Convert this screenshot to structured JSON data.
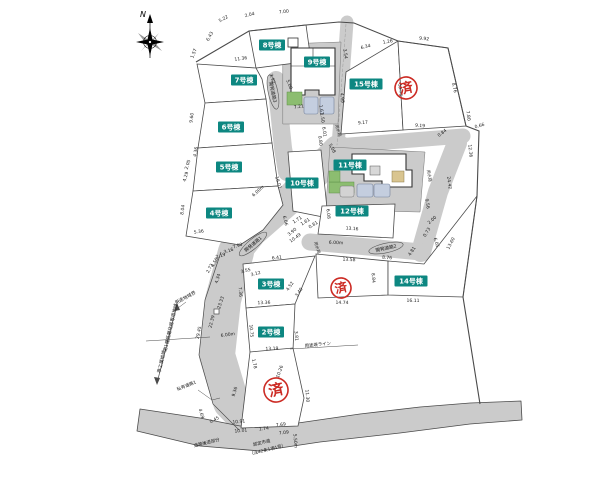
{
  "map": {
    "width": 600,
    "height": 477,
    "background": "#ffffff"
  },
  "colors": {
    "road": "#cbcbcb",
    "lot_fill": "#ffffff",
    "line": "#4a4a4a",
    "chip_bg": "#0d8781",
    "chip_text": "#ffffff",
    "stamp_red": "#cc2b24",
    "green": "#8cbd70",
    "parking_blue": "#c4cedf",
    "tan": "#d9c590"
  },
  "compass": {
    "label": "N",
    "x": 150,
    "y": 42
  },
  "lot_chips": [
    {
      "label": "8号棟",
      "x": 272,
      "y": 45
    },
    {
      "label": "9号棟",
      "x": 317,
      "y": 62
    },
    {
      "label": "7号棟",
      "x": 244,
      "y": 80
    },
    {
      "label": "15号棟",
      "x": 366,
      "y": 84
    },
    {
      "label": "6号棟",
      "x": 231,
      "y": 127
    },
    {
      "label": "5号棟",
      "x": 229,
      "y": 167
    },
    {
      "label": "11号棟",
      "x": 350,
      "y": 165
    },
    {
      "label": "10号棟",
      "x": 302,
      "y": 183
    },
    {
      "label": "12号棟",
      "x": 352,
      "y": 211
    },
    {
      "label": "4号棟",
      "x": 219,
      "y": 213
    },
    {
      "label": "3号棟",
      "x": 271,
      "y": 284
    },
    {
      "label": "14号棟",
      "x": 411,
      "y": 281
    },
    {
      "label": "2号棟",
      "x": 271,
      "y": 332
    }
  ],
  "stamps": [
    {
      "label": "済",
      "x": 406,
      "y": 88,
      "r": 11
    },
    {
      "label": "済",
      "x": 341,
      "y": 288,
      "r": 10
    },
    {
      "label": "済",
      "x": 276,
      "y": 390,
      "r": 12
    }
  ],
  "road_labels": [
    {
      "t": "開発道路1",
      "x": 253,
      "y": 244,
      "r": -40
    },
    {
      "t": "開発道路2",
      "x": 386,
      "y": 248,
      "r": -12
    },
    {
      "t": "開発道路3",
      "x": 273,
      "y": 92,
      "r": 78
    }
  ],
  "water_labels": [
    {
      "t": "用水路",
      "x": 337,
      "y": 131,
      "r": 72
    },
    {
      "t": "用水路",
      "x": 428,
      "y": 176,
      "r": 80
    },
    {
      "t": "用水路",
      "x": 316,
      "y": 248,
      "r": 72
    }
  ],
  "zoning": {
    "boundary_label": {
      "t": "用途地域界",
      "x": 186,
      "y": 299,
      "r": -28
    },
    "upper": {
      "t": "第1種低層住居専用地域",
      "x": 172,
      "y": 328,
      "r": -77
    },
    "lower": {
      "t": "準工業地域",
      "x": 163,
      "y": 362,
      "r": -77
    }
  },
  "misc_labels": [
    {
      "t": "私有道路1",
      "x": 187,
      "y": 387,
      "r": -22
    },
    {
      "t": "用途境ライン",
      "x": 318,
      "y": 346,
      "r": -6
    },
    {
      "t": "道路後退部分",
      "x": 207,
      "y": 444,
      "r": -14
    },
    {
      "t": "認定市道",
      "x": 262,
      "y": 444,
      "r": -14
    },
    {
      "t": "（法42条1項1号）",
      "x": 268,
      "y": 451,
      "r": -14
    }
  ],
  "dimensions": [
    {
      "t": "5.22",
      "x": 224,
      "y": 20,
      "r": -28
    },
    {
      "t": "2.04",
      "x": 250,
      "y": 16,
      "r": -14
    },
    {
      "t": "7.00",
      "x": 284,
      "y": 13,
      "r": -6
    },
    {
      "t": "6.43",
      "x": 211,
      "y": 37,
      "r": -62
    },
    {
      "t": "1.57",
      "x": 195,
      "y": 54,
      "r": -68
    },
    {
      "t": "11.36",
      "x": 241,
      "y": 60,
      "r": -8
    },
    {
      "t": "3.92",
      "x": 271,
      "y": 79,
      "r": 72
    },
    {
      "t": "5.00",
      "x": 288,
      "y": 85,
      "r": 68
    },
    {
      "t": "7.21",
      "x": 299,
      "y": 108,
      "r": -8
    },
    {
      "t": "3.54",
      "x": 344,
      "y": 54,
      "r": 82
    },
    {
      "t": "4.98",
      "x": 341,
      "y": 98,
      "r": 84
    },
    {
      "t": "6.34",
      "x": 366,
      "y": 48,
      "r": -14
    },
    {
      "t": "1.26",
      "x": 388,
      "y": 43,
      "r": -10
    },
    {
      "t": "9.92",
      "x": 424,
      "y": 40,
      "r": 6
    },
    {
      "t": "13.76",
      "x": 399,
      "y": 90,
      "r": 86
    },
    {
      "t": "8.76",
      "x": 453,
      "y": 88,
      "r": 78
    },
    {
      "t": "9.17",
      "x": 363,
      "y": 124,
      "r": -4
    },
    {
      "t": "9.19",
      "x": 420,
      "y": 127,
      "r": 4
    },
    {
      "t": "0.84",
      "x": 443,
      "y": 134,
      "r": -38
    },
    {
      "t": "7.80",
      "x": 467,
      "y": 116,
      "r": 82
    },
    {
      "t": "0.66",
      "x": 480,
      "y": 127,
      "r": -16
    },
    {
      "t": "12.36",
      "x": 469,
      "y": 151,
      "r": 84
    },
    {
      "t": "9.60",
      "x": 193,
      "y": 118,
      "r": -82
    },
    {
      "t": "4.36",
      "x": 197,
      "y": 152,
      "r": -80
    },
    {
      "t": "2.05",
      "x": 189,
      "y": 165,
      "r": -72
    },
    {
      "t": "4.29",
      "x": 187,
      "y": 177,
      "r": -74
    },
    {
      "t": "8.04",
      "x": 184,
      "y": 210,
      "r": -82
    },
    {
      "t": "5.36",
      "x": 199,
      "y": 233,
      "r": -8
    },
    {
      "t": "6.00m",
      "x": 259,
      "y": 192,
      "r": -42
    },
    {
      "t": "16.01",
      "x": 277,
      "y": 183,
      "r": 74
    },
    {
      "t": "6.06",
      "x": 284,
      "y": 221,
      "r": 76
    },
    {
      "t": "3.90",
      "x": 293,
      "y": 233,
      "r": -38
    },
    {
      "t": "7.90",
      "x": 238,
      "y": 247,
      "r": -18
    },
    {
      "t": "3.16",
      "x": 229,
      "y": 252,
      "r": -18
    },
    {
      "t": "2.19",
      "x": 221,
      "y": 257,
      "r": -18
    },
    {
      "t": "4.50",
      "x": 216,
      "y": 263,
      "r": -62
    },
    {
      "t": "2.72",
      "x": 211,
      "y": 269,
      "r": -62
    },
    {
      "t": "4.34",
      "x": 219,
      "y": 279,
      "r": -72
    },
    {
      "t": "3.55",
      "x": 246,
      "y": 272,
      "r": -14
    },
    {
      "t": "3.12",
      "x": 256,
      "y": 275,
      "r": -14
    },
    {
      "t": "1.71",
      "x": 298,
      "y": 221,
      "r": -32
    },
    {
      "t": "1.61",
      "x": 306,
      "y": 223,
      "r": -32
    },
    {
      "t": "0.81",
      "x": 314,
      "y": 226,
      "r": -32
    },
    {
      "t": "10.49",
      "x": 296,
      "y": 239,
      "r": -36
    },
    {
      "t": "1.61",
      "x": 320,
      "y": 110,
      "r": 82
    },
    {
      "t": "1.50",
      "x": 321,
      "y": 118,
      "r": 82
    },
    {
      "t": "6.01",
      "x": 323,
      "y": 132,
      "r": 82
    },
    {
      "t": "0.80",
      "x": 319,
      "y": 141,
      "r": 82
    },
    {
      "t": "5.08",
      "x": 331,
      "y": 149,
      "r": 62
    },
    {
      "t": "9.56",
      "x": 426,
      "y": 204,
      "r": 80
    },
    {
      "t": "24.42",
      "x": 448,
      "y": 183,
      "r": 82
    },
    {
      "t": "2.00",
      "x": 433,
      "y": 221,
      "r": -42
    },
    {
      "t": "0.73",
      "x": 428,
      "y": 233,
      "r": -58
    },
    {
      "t": "6.05",
      "x": 435,
      "y": 243,
      "r": 72
    },
    {
      "t": "6.08",
      "x": 327,
      "y": 214,
      "r": 84
    },
    {
      "t": "13.16",
      "x": 352,
      "y": 230,
      "r": 4
    },
    {
      "t": "6.00m",
      "x": 336,
      "y": 244,
      "r": 2
    },
    {
      "t": "8.76",
      "x": 387,
      "y": 259,
      "r": 4
    },
    {
      "t": "4.81",
      "x": 413,
      "y": 252,
      "r": -56
    },
    {
      "t": "13.58",
      "x": 349,
      "y": 261,
      "r": 2
    },
    {
      "t": "8.84",
      "x": 372,
      "y": 278,
      "r": 86
    },
    {
      "t": "14.74",
      "x": 342,
      "y": 304,
      "r": 1
    },
    {
      "t": "16.11",
      "x": 413,
      "y": 302,
      "r": 1
    },
    {
      "t": "13.60",
      "x": 452,
      "y": 244,
      "r": -62
    },
    {
      "t": "6.41",
      "x": 277,
      "y": 259,
      "r": -6
    },
    {
      "t": "4.52",
      "x": 291,
      "y": 287,
      "r": -56
    },
    {
      "t": "3.40",
      "x": 300,
      "y": 293,
      "r": -56
    },
    {
      "t": "7.36",
      "x": 239,
      "y": 292,
      "r": 86
    },
    {
      "t": "13.36",
      "x": 264,
      "y": 304,
      "r": -2
    },
    {
      "t": "10.75",
      "x": 250,
      "y": 331,
      "r": 86
    },
    {
      "t": "13.19",
      "x": 272,
      "y": 350,
      "r": -2
    },
    {
      "t": "3.81",
      "x": 295,
      "y": 336,
      "r": 86
    },
    {
      "t": "23.33",
      "x": 222,
      "y": 303,
      "r": -72
    },
    {
      "t": "22.39",
      "x": 213,
      "y": 322,
      "r": -76
    },
    {
      "t": "29.45",
      "x": 200,
      "y": 333,
      "r": -78
    },
    {
      "t": "6.00m",
      "x": 228,
      "y": 336,
      "r": -8
    },
    {
      "t": "1.78",
      "x": 253,
      "y": 364,
      "r": 78
    },
    {
      "t": "10.26",
      "x": 281,
      "y": 372,
      "r": -70
    },
    {
      "t": "9.36",
      "x": 236,
      "y": 392,
      "r": -74
    },
    {
      "t": "11.30",
      "x": 306,
      "y": 396,
      "r": 86
    },
    {
      "t": "4.69",
      "x": 200,
      "y": 414,
      "r": 74
    },
    {
      "t": "0.45",
      "x": 215,
      "y": 421,
      "r": -28
    },
    {
      "t": "10.91",
      "x": 239,
      "y": 423,
      "r": -6
    },
    {
      "t": "10.01",
      "x": 241,
      "y": 432,
      "r": -6
    },
    {
      "t": "1.74",
      "x": 264,
      "y": 430,
      "r": -6
    },
    {
      "t": "7.69",
      "x": 281,
      "y": 426,
      "r": -6
    },
    {
      "t": "7.09",
      "x": 284,
      "y": 434,
      "r": -6
    },
    {
      "t": "5.50m",
      "x": 294,
      "y": 441,
      "r": 86
    }
  ]
}
